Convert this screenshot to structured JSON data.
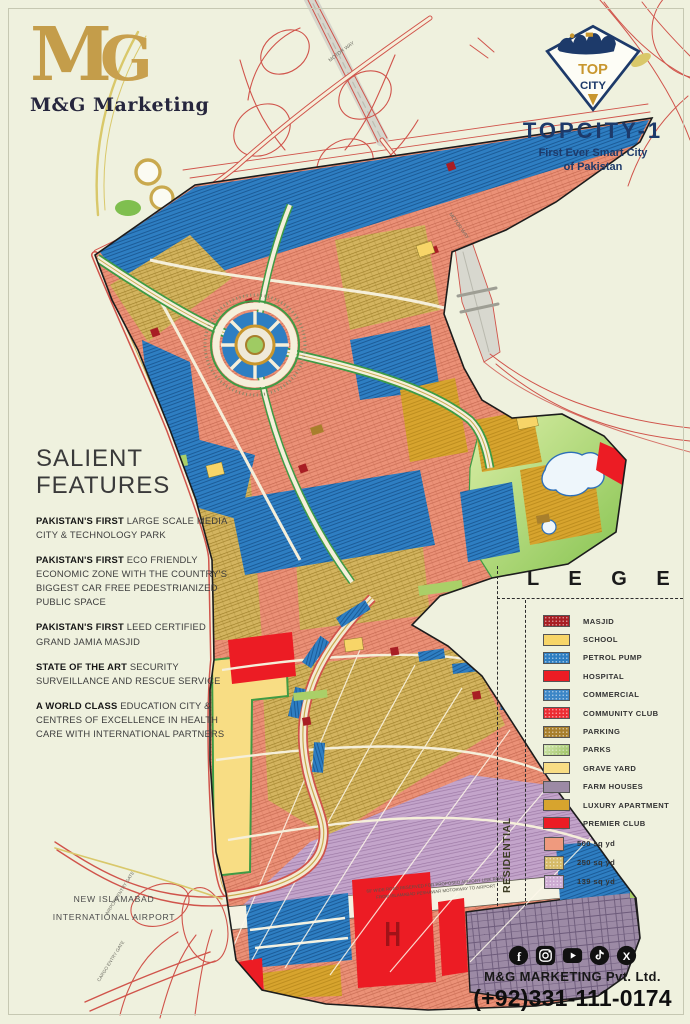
{
  "branding": {
    "monogram_m": "M",
    "monogram_g": "G",
    "name": "M&G Marketing"
  },
  "topcity": {
    "logo_top_word": "TOP",
    "logo_bottom_word": "CITY",
    "title": "TOPCITY-1",
    "subtitle_line1": "First Ever Smart City",
    "subtitle_line2": "of Pakistan",
    "navy": "#1d3a6a",
    "gold": "#c8962e"
  },
  "salient": {
    "title_line1": "SALIENT",
    "title_line2": "FEATURES",
    "items": [
      {
        "lead": "PAKISTAN'S FIRST",
        "rest": " LARGE SCALE MEDIA CITY & TECHNOLOGY PARK"
      },
      {
        "lead": "PAKISTAN'S FIRST",
        "rest": " ECO FRIENDLY ECONOMIC ZONE WITH THE COUNTRY'S BIGGEST CAR FREE PEDESTRIANIZED PUBLIC SPACE"
      },
      {
        "lead": "PAKISTAN'S FIRST",
        "rest": " LEED CERTIFIED GRAND JAMIA MASJID"
      },
      {
        "lead": "STATE OF THE ART",
        "rest": " SECURITY SURVEILLANCE AND RESCUE SERVICE"
      },
      {
        "lead": "A WORLD CLASS",
        "rest": " EDUCATION CITY & CENTRES OF EXCELLENCE IN HEALTH CARE WITH INTERNATIONAL PARTNERS"
      }
    ]
  },
  "legend": {
    "title": "L E G E N D",
    "items": [
      {
        "label": "MASJID",
        "color": "#a81e24",
        "texture": "dots"
      },
      {
        "label": "SCHOOL",
        "color": "#f7d568",
        "texture": "solid"
      },
      {
        "label": "PETROL PUMP",
        "color": "#2e7ec2",
        "texture": "dots"
      },
      {
        "label": "HOSPITAL",
        "color": "#ec1c24",
        "texture": "solid"
      },
      {
        "label": "COMMERCIAL",
        "color": "#3c86c6",
        "texture": "dots"
      },
      {
        "label": "COMMUNITY CLUB",
        "color": "#ec2c33",
        "texture": "dots"
      },
      {
        "label": "PARKING",
        "color": "#a87f2c",
        "texture": "dots"
      },
      {
        "label": "PARKS",
        "color": "#abd36c",
        "texture": "grad"
      },
      {
        "label": "GRAVE YARD",
        "color": "#f8dd84",
        "texture": "solid"
      },
      {
        "label": "FARM HOUSES",
        "color": "#9c8aa5",
        "texture": "solid"
      },
      {
        "label": "LUXURY APARTMENT",
        "color": "#d7a42e",
        "texture": "solid"
      },
      {
        "label": "PREMIER CLUB",
        "color": "#ec1c24",
        "texture": "solid"
      }
    ],
    "residential_label": "RESIDENTIAL",
    "residential_items": [
      {
        "label": "500 sq yd",
        "color": "#ef9a7e",
        "texture": "solid"
      },
      {
        "label": "250 sq yd",
        "color": "#d6bb69",
        "texture": "dots"
      },
      {
        "label": "139 sq yd",
        "color": "#cdabd2",
        "texture": "dots"
      }
    ]
  },
  "footer": {
    "social_icons": [
      "facebook-icon",
      "instagram-icon",
      "youtube-icon",
      "tiktok-icon",
      "x-icon"
    ],
    "company": "M&G MARKETING Pvt. Ltd.",
    "phone": "(+92)331-111-0174"
  },
  "map_labels": {
    "airport_line1": "NEW ISLAMABAD",
    "airport_line2": "INTERNATIONAL AIRPORT",
    "airport_gate": "AIRPORT ENTRY GATE",
    "cargo_gate": "CARGO ENTRY GATE",
    "motorway_top": "MOTOR WAY",
    "motorway_right": "MOTOR WAY",
    "link_road_line1": "60' WIDE ROAD RESERVED FOR PROPOSED AIRPORT LINK ROAD",
    "link_road_line2": "FROM ISLAMABAD PESHAWAR MOTORWAY TO AIRPORT"
  }
}
